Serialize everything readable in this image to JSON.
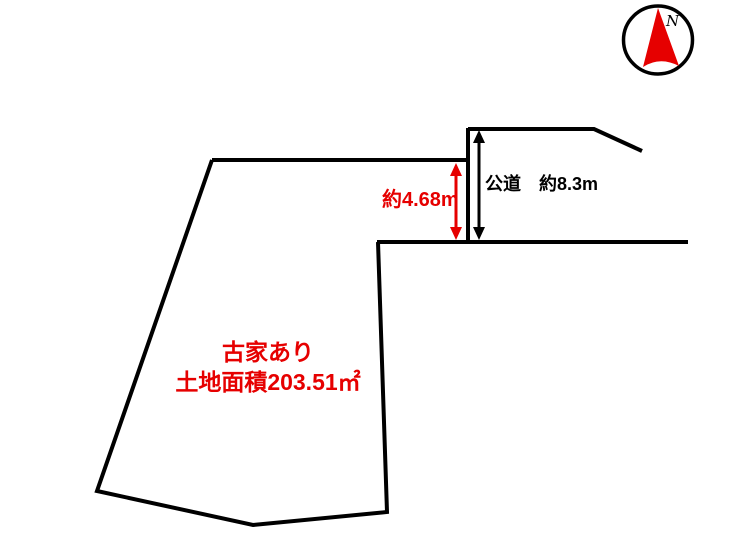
{
  "compass": {
    "north_label": "N",
    "needle_color": "#e60000"
  },
  "plot": {
    "caption_line1": "古家あり",
    "caption_line2": "土地面積203.51㎡",
    "caption_color": "#e60000"
  },
  "dimensions": {
    "frontage_label": "約4.68m",
    "road_label": "公道　約8.3m"
  },
  "colors": {
    "line": "#000000",
    "accent_red": "#e60000",
    "background": "#ffffff"
  }
}
